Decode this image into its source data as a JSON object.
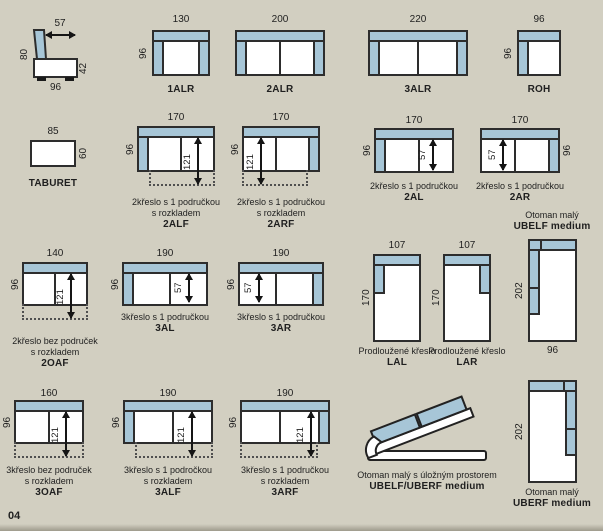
{
  "page": {
    "number": "04"
  },
  "palette": {
    "background": "#d2cfc1",
    "upholstery": "#a7c6d7",
    "outline": "#2d2d2d"
  },
  "sideview": {
    "dim_top": "57",
    "dim_left": "80",
    "dim_right": "42",
    "dim_bottom": "96"
  },
  "modules": {
    "m1alr": {
      "code": "1ALR",
      "dim_top": "130",
      "dim_left": "96"
    },
    "m2alr": {
      "code": "2ALR",
      "dim_top": "200"
    },
    "m3alr": {
      "code": "3ALR",
      "dim_top": "220"
    },
    "roh": {
      "code": "ROH",
      "dim_top": "96",
      "dim_left": "96"
    },
    "taburet": {
      "code": "TABURET",
      "dim_top": "85",
      "dim_right": "60"
    },
    "m2alf": {
      "code": "2ALF",
      "caption1": "2křeslo s 1 područkou",
      "caption2": "s rozkladem",
      "dim_top": "170",
      "dim_left": "96",
      "dim_inner": "121"
    },
    "m2arf": {
      "code": "2ARF",
      "caption1": "2křeslo s 1 područkou",
      "caption2": "s rozkladem",
      "dim_top": "170",
      "dim_left": "96",
      "dim_inner": "121"
    },
    "m2al": {
      "code": "2AL",
      "caption1": "2křeslo s 1 područkou",
      "dim_top": "170",
      "dim_left": "96",
      "dim_inner": "57"
    },
    "m2ar": {
      "code": "2AR",
      "caption1": "2křeslo s 1 područkou",
      "dim_top": "170",
      "dim_right": "96",
      "dim_inner": "57"
    },
    "ubelf": {
      "code": "UBELF medium",
      "caption1": "Otoman malý",
      "dim_left": "202",
      "dim_bottom": "96"
    },
    "m2oaf": {
      "code": "2OAF",
      "caption1": "2křeslo bez područek",
      "caption2": "s rozkladem",
      "dim_top": "140",
      "dim_left": "96",
      "dim_inner": "121"
    },
    "m3al": {
      "code": "3AL",
      "caption1": "3křeslo s 1 područkou",
      "dim_top": "190",
      "dim_left": "96",
      "dim_inner": "57"
    },
    "m3ar": {
      "code": "3AR",
      "caption1": "3křeslo s 1 područkou",
      "dim_top": "190",
      "dim_left": "96",
      "dim_inner": "57"
    },
    "lal": {
      "code": "LAL",
      "caption1": "Prodloužené křeslo",
      "dim_top": "107",
      "dim_left": "170"
    },
    "lar": {
      "code": "LAR",
      "caption1": "Prodloužené křeslo",
      "dim_top": "107",
      "dim_left": "170"
    },
    "m3oaf": {
      "code": "3OAF",
      "caption1": "3křeslo bez područek",
      "caption2": "s rozkladem",
      "dim_top": "160",
      "dim_left": "96",
      "dim_inner": "121"
    },
    "m3alf": {
      "code": "3ALF",
      "caption1": "3křeslo s 1 področkou",
      "caption2": "s rozkladem",
      "dim_top": "190",
      "dim_left": "96",
      "dim_inner": "121"
    },
    "m3arf": {
      "code": "3ARF",
      "caption1": "3křeslo s 1 područkou",
      "caption2": "s rozkladem",
      "dim_top": "190",
      "dim_left": "96",
      "dim_inner": "121"
    },
    "storage": {
      "code": "UBELF/UBERF medium",
      "caption1": "Otoman malý s úložným prostorem"
    },
    "uberf": {
      "code": "UBERF medium",
      "caption1": "Otoman malý",
      "dim_left": "202"
    }
  }
}
